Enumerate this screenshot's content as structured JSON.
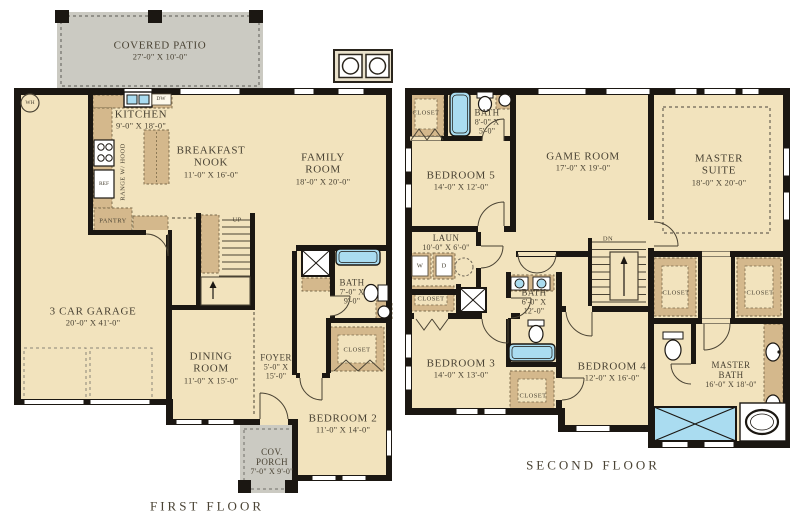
{
  "plan_title": "Two-story floor plan",
  "first_floor": {
    "title": "FIRST FLOOR",
    "rooms": {
      "covered_patio": {
        "name": "COVERED PATIO",
        "dims": "27'-0\" X 10'-0\""
      },
      "kitchen": {
        "name": "KITCHEN",
        "dims": "9'-0\" X 18'-0\""
      },
      "breakfast_nook": {
        "name": "BREAKFAST NOOK",
        "dims": "11'-0\" X 16'-0\""
      },
      "family_room": {
        "name": "FAMILY ROOM",
        "dims": "18'-0\" X 20'-0\""
      },
      "garage": {
        "name": "3 CAR GARAGE",
        "dims": "20'-0\" X 41'-0\""
      },
      "dining_room": {
        "name": "DINING ROOM",
        "dims": "11'-0\" X 15'-0\""
      },
      "foyer": {
        "name": "FOYER",
        "dims": "5'-0\" X 15'-0\""
      },
      "bath": {
        "name": "BATH",
        "dims": "7'-0\" X 9'-0\""
      },
      "bedroom_2": {
        "name": "BEDROOM 2",
        "dims": "11'-0\" X 14'-0\""
      },
      "cov_porch": {
        "name": "COV. PORCH",
        "dims": "7'-0\" X 9'-0\""
      }
    },
    "closet_label": "CLOSET",
    "annotations": {
      "wh": "WH",
      "dw": "DW",
      "range": "RANGE W/ HOOD",
      "ref": "REF",
      "pantry": "PANTRY",
      "up": "UP"
    }
  },
  "second_floor": {
    "title": "SECOND FLOOR",
    "rooms": {
      "bedroom_5": {
        "name": "BEDROOM 5",
        "dims": "14'-0\" X 12'-0\""
      },
      "bath_upper": {
        "name": "BATH",
        "dims": "8'-0\" X 5'-0\""
      },
      "game_room": {
        "name": "GAME ROOM",
        "dims": "17'-0\" X 19'-0\""
      },
      "master_suite": {
        "name": "MASTER SUITE",
        "dims": "18'-0\" X 20'-0\""
      },
      "laundry": {
        "name": "LAUN",
        "dims": "10'-0\" X 6'-0\""
      },
      "bath_middle": {
        "name": "BATH",
        "dims": "6'-0\" X 12'-0\""
      },
      "bedroom_3": {
        "name": "BEDROOM 3",
        "dims": "14'-0\" X 13'-0\""
      },
      "bedroom_4": {
        "name": "BEDROOM 4",
        "dims": "12'-0\" X 16'-0\""
      },
      "master_bath": {
        "name": "MASTER BATH",
        "dims": "16'-0\" X 18'-0\""
      }
    },
    "closet_label": "CLOSET",
    "annotations": {
      "dn": "DN",
      "w": "W",
      "d": "D"
    }
  },
  "colors": {
    "wall": "#1b1712",
    "room_fill": "#f2e3bd",
    "patio_gray": "#cbcac2",
    "cabinet_tan": "#d4b88c",
    "fixture_blue": "#aadcf0",
    "text": "#4a4334"
  }
}
